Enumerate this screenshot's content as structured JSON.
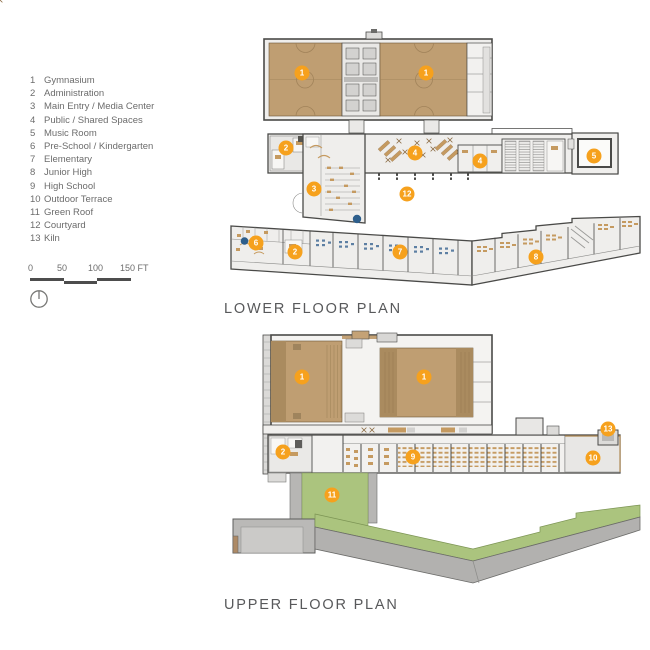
{
  "legend": {
    "items": [
      {
        "num": "1",
        "label": "Gymnasium"
      },
      {
        "num": "2",
        "label": "Administration"
      },
      {
        "num": "3",
        "label": "Main Entry / Media Center"
      },
      {
        "num": "4",
        "label": "Public / Shared Spaces"
      },
      {
        "num": "5",
        "label": "Music Room"
      },
      {
        "num": "6",
        "label": "Pre-School / Kindergarten"
      },
      {
        "num": "7",
        "label": "Elementary"
      },
      {
        "num": "8",
        "label": "Junior High"
      },
      {
        "num": "9",
        "label": "High School"
      },
      {
        "num": "10",
        "label": "Outdoor Terrace"
      },
      {
        "num": "11",
        "label": "Green Roof"
      },
      {
        "num": "12",
        "label": "Courtyard"
      },
      {
        "num": "13",
        "label": "Kiln"
      }
    ]
  },
  "scale_bar": {
    "labels": [
      "0",
      "50",
      "100",
      "150 FT"
    ]
  },
  "plans": {
    "lower": {
      "title": "LOWER FLOOR PLAN",
      "markers": [
        {
          "num": "1",
          "x": 302,
          "y": 73
        },
        {
          "num": "1",
          "x": 426,
          "y": 73
        },
        {
          "num": "2",
          "x": 286,
          "y": 148
        },
        {
          "num": "4",
          "x": 415,
          "y": 153
        },
        {
          "num": "4",
          "x": 480,
          "y": 161
        },
        {
          "num": "5",
          "x": 594,
          "y": 156
        },
        {
          "num": "3",
          "x": 314,
          "y": 189
        },
        {
          "num": "12",
          "x": 407,
          "y": 194
        },
        {
          "num": "6",
          "x": 256,
          "y": 243
        },
        {
          "num": "2",
          "x": 295,
          "y": 252
        },
        {
          "num": "7",
          "x": 400,
          "y": 252
        },
        {
          "num": "8",
          "x": 536,
          "y": 257
        }
      ]
    },
    "upper": {
      "title": "UPPER FLOOR PLAN",
      "markers": [
        {
          "num": "1",
          "x": 302,
          "y": 377
        },
        {
          "num": "1",
          "x": 424,
          "y": 377
        },
        {
          "num": "2",
          "x": 283,
          "y": 452
        },
        {
          "num": "9",
          "x": 413,
          "y": 457
        },
        {
          "num": "13",
          "x": 608,
          "y": 429
        },
        {
          "num": "10",
          "x": 593,
          "y": 458
        },
        {
          "num": "11",
          "x": 332,
          "y": 495
        }
      ]
    }
  },
  "colors": {
    "accent_orange": "#f6a11d",
    "gym_tan": "#bf9e72",
    "gym_tan_dark": "#aa8b5f",
    "green_roof": "#abc47e",
    "roof_gray": "#b2b1af",
    "wall_dark": "#4a4a48",
    "floor_light": "#efeeec",
    "furniture_tan": "#c59a60",
    "furniture_blue": "#5d7fa3",
    "dot_blue": "#2e5f8c",
    "text_gray": "#6c6c6c",
    "title_gray": "#58595b"
  }
}
